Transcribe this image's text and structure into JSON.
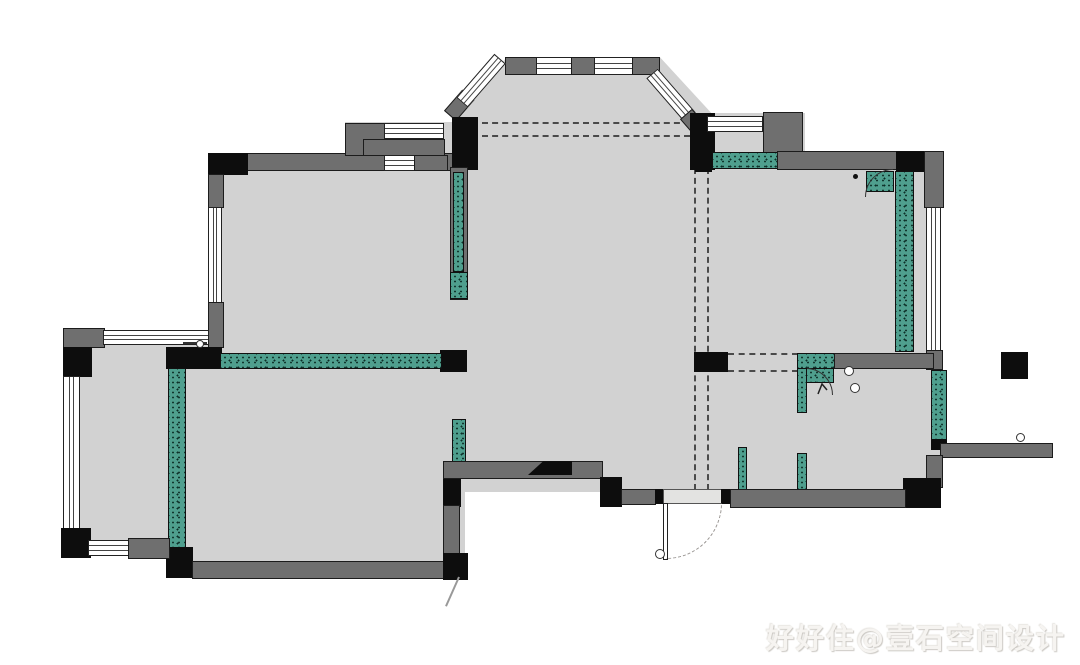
{
  "title": "apartment-floor-plan",
  "watermark": {
    "text": "好好住@壹石空间设计"
  },
  "palette": {
    "background": "#ffffff",
    "floor_gray": "#d2d2d2",
    "existing_wall_gray": "#6f6f6f",
    "structural_black": "#0d0d0d",
    "new_wall_teal": "#4f9f8e",
    "window_white": "#ffffff",
    "dashed_line_gray": "#4a4a4a",
    "door_arc_gray": "#979390"
  }
}
